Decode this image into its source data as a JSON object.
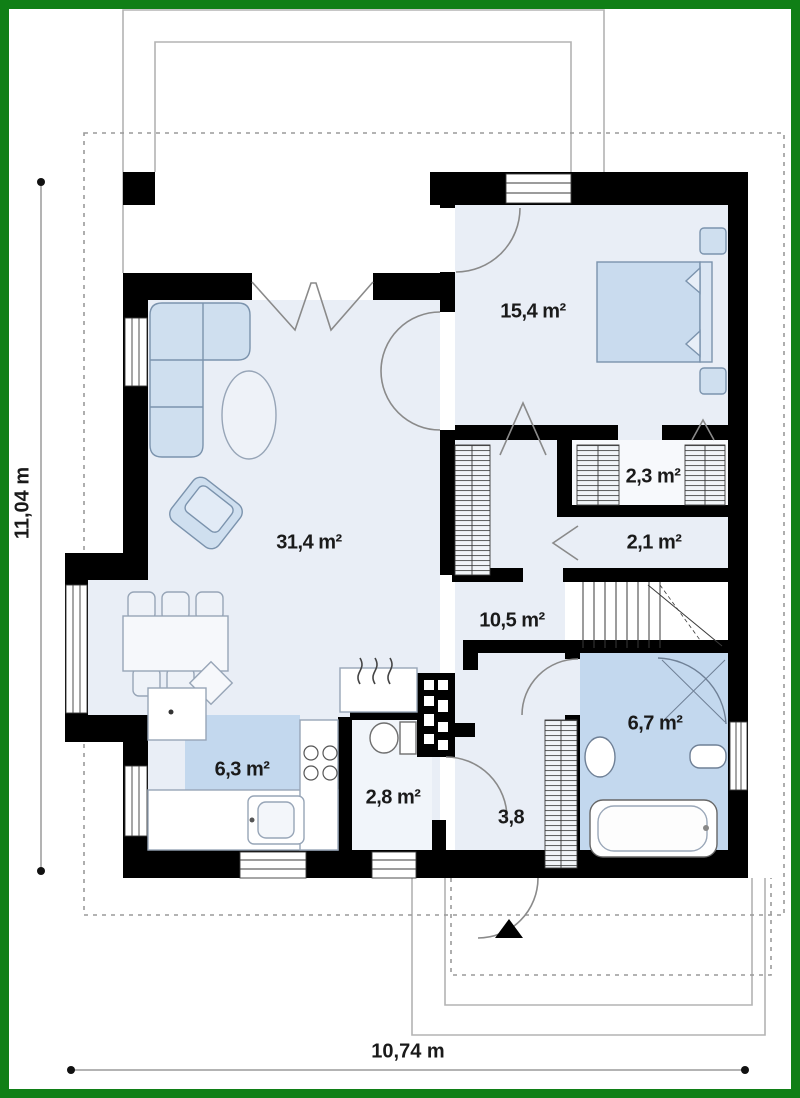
{
  "plan_title": "single floor house plan",
  "rooms": {
    "living": {
      "label": "31,4 m²"
    },
    "bedroom": {
      "label": "15,4 m²"
    },
    "wardrobe": {
      "label": "2,3 m²"
    },
    "corridor": {
      "label": "2,1 m²"
    },
    "hall": {
      "label": "10,5 m²"
    },
    "bathroom": {
      "label": "6,7 m²"
    },
    "kitchen": {
      "label": "6,3 m²"
    },
    "wc": {
      "label": "2,8 m²"
    },
    "entry": {
      "label": "3,8"
    }
  },
  "dimensions": {
    "height_label": "11,04 m",
    "width_label": "10,74 m"
  },
  "colors": {
    "frame_green": "#107f16",
    "floor_light": "#e9eef6",
    "floor_blue": "#c3d8ee",
    "furniture_blue": "#cfdfef",
    "wall_black": "#000000"
  }
}
